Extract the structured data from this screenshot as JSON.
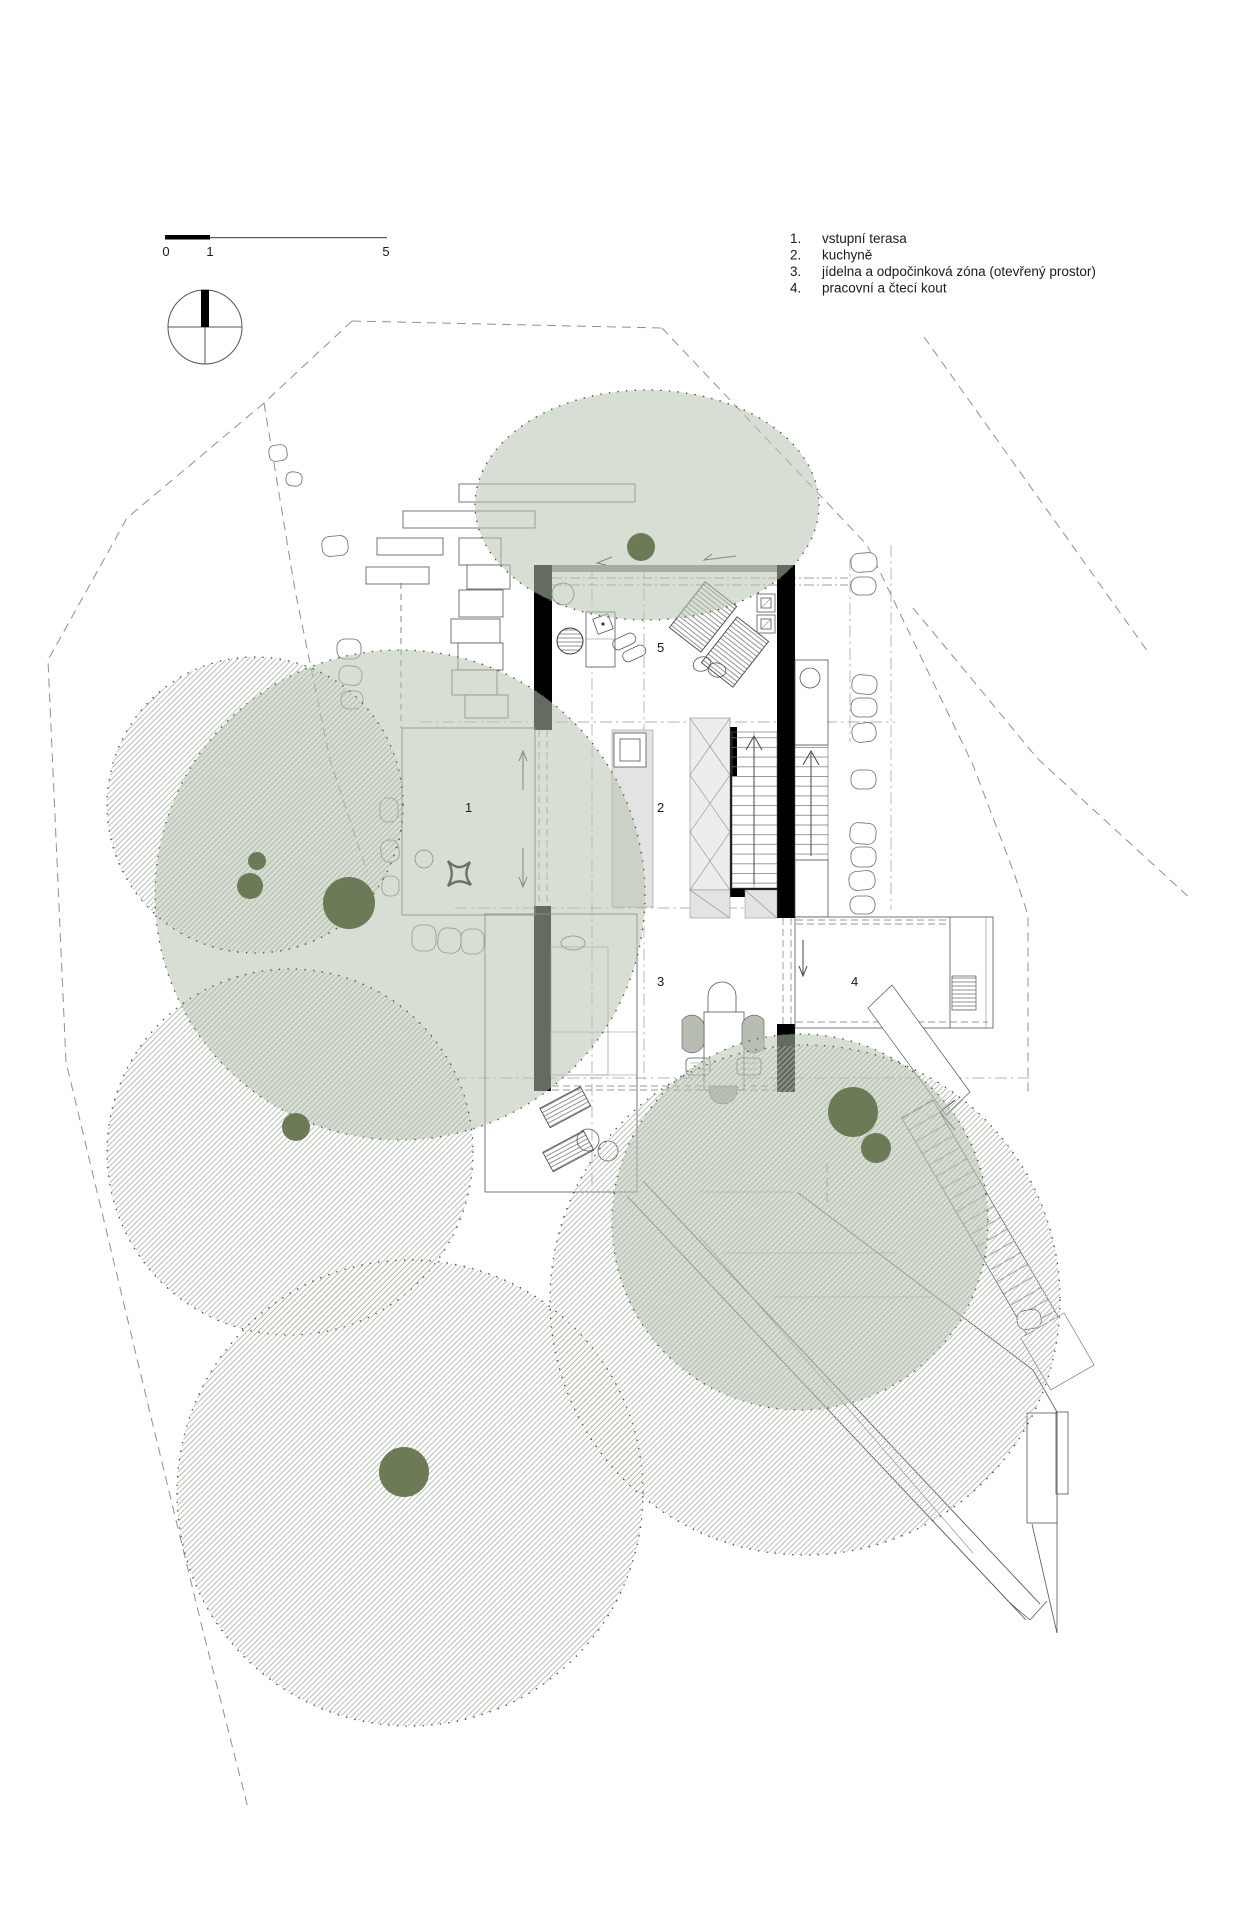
{
  "legend": {
    "items": [
      {
        "num": "1.",
        "label": "vstupní terasa"
      },
      {
        "num": "2.",
        "label": "kuchyně"
      },
      {
        "num": "3.",
        "label": "jídelna a odpočinková zóna (otevřený prostor)"
      },
      {
        "num": "4.",
        "label": "pracovní a čtecí kout"
      }
    ]
  },
  "scalebar": {
    "labels": [
      "0",
      "1",
      "5"
    ]
  },
  "plan": {
    "room_numbers": [
      "1",
      "2",
      "3",
      "4",
      "5"
    ]
  },
  "colors": {
    "wall": "#000000",
    "line": "#555555",
    "light-line": "#888888",
    "boundary": "#909090",
    "canopy_fill": "#b7c2b1",
    "canopy_edge": "#4a5244",
    "trunk": "#6d7a58",
    "hatch_line": "#aab5a3",
    "floor_gray": "#e3e3e3",
    "text": "#1a1a1a"
  }
}
